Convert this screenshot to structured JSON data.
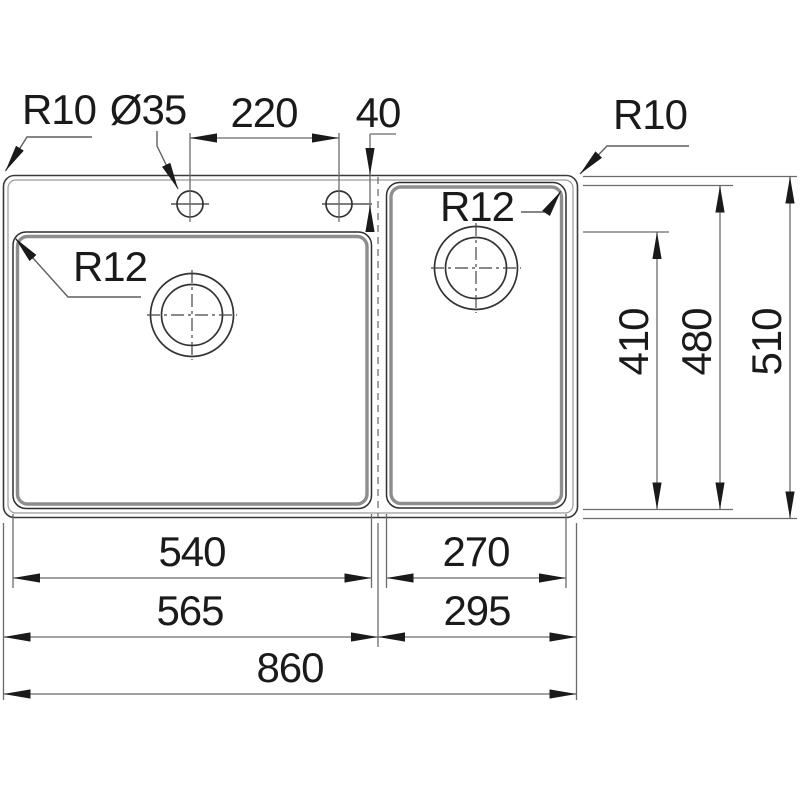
{
  "colors": {
    "background": "#ffffff",
    "line_dark": "#2f2f2f",
    "line_gray": "#8d8d8d",
    "dimension_line": "#6b6b6b",
    "text": "#1a1a1a"
  },
  "labels": {
    "outer_corner_radius_left": "R10",
    "faucet_hole_diameter": "Ø35",
    "faucet_hole_spacing": "220",
    "faucet_hole_edge_offset": "40",
    "outer_corner_radius_right": "R10",
    "main_bowl_corner_radius": "R12",
    "second_bowl_corner_radius": "R12",
    "main_bowl_depth": "410",
    "second_bowl_depth": "480",
    "overall_depth": "510",
    "main_bowl_width": "540",
    "second_bowl_width": "270",
    "main_section_width": "565",
    "second_section_width": "295",
    "overall_width": "860"
  }
}
